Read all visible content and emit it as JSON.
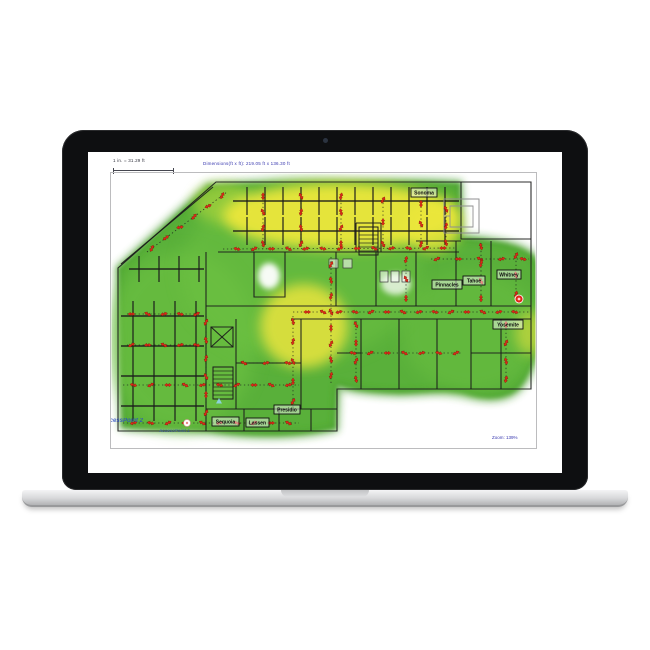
{
  "device": {
    "type": "macbook-laptop",
    "bezel_color": "#0e0f11",
    "base_color": "#d7d8da"
  },
  "app": {
    "scale_label": "1 in. = 31.29 ft",
    "dimensions_label": "Dimensions(ft x ft): 219.05 ft x 136.30 ft",
    "zoom_label": "Zoom: 139%",
    "colors": {
      "wall": "#1b1b1b",
      "gray_wall": "#8f8f90",
      "survey_line": "#1c1c1c",
      "marker_red": "#e02818",
      "marker_red_dark": "#7a0d05",
      "heat_green": "#53ad33",
      "heat_green_dark": "#3f9727",
      "heat_green_light": "#6ec243",
      "heat_yellow": "#ece73b",
      "label_blue": "#3636ae",
      "watermark_blue": "#2d4fc0"
    },
    "rooms": [
      {
        "name": "Sonoma",
        "x": 410,
        "y": 187,
        "w": 26,
        "h": 9
      },
      {
        "name": "Pinnacles",
        "x": 431,
        "y": 279,
        "w": 30,
        "h": 9
      },
      {
        "name": "Tahoe",
        "x": 462,
        "y": 275,
        "w": 22,
        "h": 9
      },
      {
        "name": "Whitney",
        "x": 496,
        "y": 269,
        "w": 24,
        "h": 9
      },
      {
        "name": "Yosemite",
        "x": 492,
        "y": 319,
        "w": 30,
        "h": 9
      },
      {
        "name": "Presidio",
        "x": 273,
        "y": 404,
        "w": 26,
        "h": 9
      },
      {
        "name": "Sequoia",
        "x": 211,
        "y": 416,
        "w": 27,
        "h": 9
      },
      {
        "name": "Lassen",
        "x": 245,
        "y": 417,
        "w": 23,
        "h": 9
      }
    ],
    "watermarks": [
      {
        "text": "AccessPoint 2",
        "x": 101,
        "y": 421,
        "size": 6,
        "opacity": 0.85
      },
      {
        "text": "AccessPoint 1",
        "x": 158,
        "y": 431,
        "size": 4.5,
        "opacity": 0.55
      }
    ],
    "plan": {
      "cov": "M207,184 C280,180 420,178 459,182 L461,236 C490,238 520,242 533,255 C545,270 544,300 541,320 C538,352 530,375 518,388 C505,400 485,400 465,394 C440,388 420,394 395,393 C370,392 350,390 337,385 L335,428 C300,437 250,437 210,431 C180,428 140,430 121,426 L117,267 Z",
      "heat": [
        {
          "d": "COV",
          "fill": "#53ad33",
          "o": 0.96,
          "blur": 2
        },
        {
          "d": "COV",
          "fill": "none",
          "stroke": "#3f9727",
          "sw": 5,
          "o": 0.75,
          "blur": 4
        },
        {
          "cx": 180,
          "cy": 340,
          "rx": 75,
          "ry": 90,
          "fill": "#6ec243",
          "o": 0.6,
          "blur": 8
        },
        {
          "cx": 300,
          "cy": 270,
          "rx": 120,
          "ry": 90,
          "fill": "#6ec243",
          "o": 0.5,
          "blur": 8
        },
        {
          "cx": 470,
          "cy": 330,
          "rx": 70,
          "ry": 60,
          "fill": "#6ec243",
          "o": 0.45,
          "blur": 8
        },
        {
          "cx": 222,
          "cy": 202,
          "rx": 30,
          "ry": 20,
          "fill": "#b5d93e",
          "o": 0.6,
          "blur": 6
        },
        {
          "cx": 340,
          "cy": 215,
          "rx": 118,
          "ry": 33,
          "fill": "#ece73b",
          "o": 0.95,
          "blur": 6
        },
        {
          "cx": 432,
          "cy": 225,
          "rx": 28,
          "ry": 26,
          "fill": "#ece73b",
          "o": 0.8,
          "blur": 6
        },
        {
          "cx": 303,
          "cy": 325,
          "rx": 44,
          "ry": 42,
          "fill": "#e9e43c",
          "o": 0.85,
          "blur": 6
        },
        {
          "cx": 530,
          "cy": 332,
          "rx": 16,
          "ry": 22,
          "fill": "#dfe03e",
          "o": 0.6,
          "blur": 6
        },
        {
          "cx": 268,
          "cy": 275,
          "rx": 11,
          "ry": 13,
          "fill": "#ffffff",
          "o": 0.95,
          "blur": 3
        },
        {
          "cx": 395,
          "cy": 283,
          "rx": 15,
          "ry": 11,
          "fill": "#ffffff",
          "o": 0.75,
          "blur": 3
        }
      ],
      "walls": [
        "M215,181 L530,181 L530,388 L336,388 L336,430 L117,430 L117,267 Z",
        "M212,186 L120,263",
        "M217,251 L458,251",
        "M205,251 L205,430",
        "M205,305 L530,305",
        "M290,318 L530,318",
        "M253,251 L253,296 L284,296 L284,251",
        "M335,251 L335,305",
        "M375,251 L375,305",
        "M415,251 L415,305",
        "M460,181 L460,238 L530,238",
        "M455,240 L455,305",
        "M490,240 L490,305",
        "M415,240 L460,240",
        "M355,222 L355,251",
        "M380,222 L380,251",
        "M355,222 L380,222",
        "M360,318 L360,388",
        "M398,318 L398,388",
        "M436,318 L436,388",
        "M470,318 L470,388",
        "M500,318 L500,388",
        "M470,352 L530,352",
        "M336,352 L360,352",
        "M205,408 L336,408",
        "M243,408 L243,430",
        "M278,408 L278,430",
        "M310,408 L310,430",
        "M235,318 L235,408",
        "M300,318 L300,408",
        "M235,362 L300,362",
        "M210,326 h22 v20 h-22 Z",
        "M210,326 L232,346",
        "M232,326 L210,346"
      ],
      "grids": [
        {
          "x0": 232,
          "x1": 458,
          "rows": [
            200,
            230
          ],
          "t0": 246,
          "step": 18,
          "n": 12,
          "th": 14
        },
        {
          "x0": 128,
          "x1": 203,
          "rows": [
            268
          ],
          "t0": 138,
          "step": 20,
          "n": 4,
          "th": 13
        },
        {
          "x0": 120,
          "x1": 203,
          "rows": [
            315,
            345,
            375,
            405
          ],
          "t0": 132,
          "step": 21,
          "n": 4,
          "th": 15
        }
      ],
      "stairs": [
        {
          "x": 358,
          "y": 226,
          "w": 19,
          "h": 28,
          "rungs": 6
        },
        {
          "x": 212,
          "y": 366,
          "w": 20,
          "h": 32,
          "rungs": 7
        }
      ],
      "fixtures": [
        [
          379,
          270,
          8,
          11
        ],
        [
          390,
          270,
          8,
          11
        ],
        [
          401,
          270,
          8,
          11
        ],
        [
          328,
          258,
          9,
          9
        ],
        [
          342,
          258,
          9,
          9
        ]
      ],
      "gray_rooms": [
        "M443,198 h35 v34 h-35 Z",
        "M449,205 h23 v21 h-23 Z",
        "M478,198 L478,232",
        "M443,215 h6"
      ],
      "survey": [
        [
          146,
          251,
          226,
          191,
          6
        ],
        [
          222,
          248,
          456,
          247,
          13
        ],
        [
          262,
          246,
          262,
          192,
          4
        ],
        [
          300,
          246,
          300,
          192,
          4
        ],
        [
          340,
          246,
          340,
          192,
          4
        ],
        [
          382,
          246,
          382,
          196,
          3
        ],
        [
          420,
          246,
          420,
          200,
          3
        ],
        [
          445,
          244,
          445,
          206,
          3
        ],
        [
          330,
          256,
          330,
          382,
          8
        ],
        [
          292,
          311,
          528,
          311,
          14
        ],
        [
          430,
          258,
          528,
          258,
          5
        ],
        [
          405,
          256,
          405,
          300,
          3
        ],
        [
          480,
          242,
          480,
          301,
          4
        ],
        [
          515,
          252,
          515,
          296,
          3
        ],
        [
          126,
          313,
          200,
          313,
          5
        ],
        [
          126,
          344,
          200,
          344,
          5
        ],
        [
          122,
          384,
          298,
          384,
          10
        ],
        [
          122,
          422,
          298,
          422,
          10
        ],
        [
          205,
          315,
          205,
          418,
          6
        ],
        [
          505,
          320,
          505,
          382,
          4
        ],
        [
          355,
          320,
          355,
          382,
          4
        ],
        [
          345,
          352,
          462,
          352,
          7
        ],
        [
          292,
          315,
          292,
          406,
          5
        ],
        [
          240,
          362,
          290,
          362,
          3
        ]
      ],
      "points": [
        {
          "type": "ap-red",
          "x": 518,
          "y": 298
        },
        {
          "type": "white-dot",
          "x": 186,
          "y": 422
        },
        {
          "type": "cursor-blue",
          "x": 218,
          "y": 400
        }
      ]
    }
  }
}
